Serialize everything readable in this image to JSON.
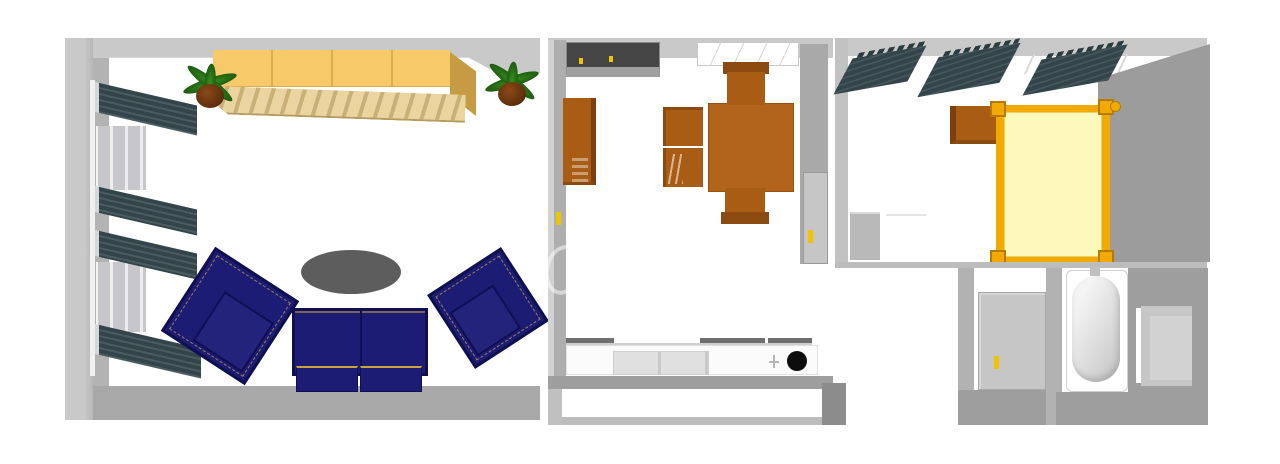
{
  "scene": {
    "kind": "3d-floor-plan-render",
    "view": "top-down bird's eye",
    "description": "Rendered floor plan of a three-section apartment: living room, kitchen-dining room, bedroom with closet and bathroom",
    "visible_text": "none"
  },
  "palette": {
    "wall-light": "#c9c9c9",
    "wall-mid": "#aeaeae",
    "wall-dark": "#9e9e9e",
    "wall-deep": "#8c8c8c",
    "slate": "#33454a",
    "slate-light": "#4a5c60",
    "wardrobe-top": "#f7c969",
    "wardrobe-side": "#c79a44",
    "slat-light": "#ead49f",
    "slat-dark": "#c8b076",
    "plant-green": "#1d5c10",
    "pot-brown": "#5a2c0c",
    "navy": "#1c1c74",
    "navy-dark": "#0f0f52",
    "navy-light": "#23237c",
    "gold-piping": "#c9a23e",
    "table-gray": "#5d5d5d",
    "wood": "#a85c14",
    "wood-dark": "#7c3f0d",
    "wood-table": "#b2641c",
    "counter-front": "#e0e0e0",
    "counter-edge": "#6e6e6e",
    "sink-black": "#0d0d0d",
    "door-gray": "#c6c6c6",
    "handle-yellow": "#f0c400",
    "bed-gold": "#f2a900",
    "bed-gold-dark": "#b37c00",
    "mattress": "#fdf8bb",
    "tub-light": "#f4f4f4",
    "tub-shade": "#c9c9c9"
  },
  "rooms": [
    {
      "id": "living-room",
      "position": "left",
      "furniture": [
        "wardrobe",
        "potted-plant-left",
        "potted-plant-right",
        "radiator-1",
        "radiator-2",
        "radiator-3",
        "radiator-4",
        "window-1",
        "window-2",
        "armchair-left",
        "armchair-right",
        "sofa-two-seat",
        "coffee-table-oval"
      ]
    },
    {
      "id": "kitchen-dining",
      "position": "center",
      "furniture": [
        "entry-door",
        "ceiling-window",
        "tall-cabinet",
        "dining-table",
        "dining-chair-top",
        "dining-chair-bottom",
        "dining-chair-left-1",
        "dining-chair-left-2",
        "kitchen-counter",
        "sink",
        "faucet",
        "side-door",
        "balcony"
      ]
    },
    {
      "id": "bedroom",
      "position": "right",
      "furniture": [
        "shelf-unit-1",
        "shelf-unit-2",
        "shelf-unit-3",
        "nightstand",
        "double-bed",
        "small-dresser"
      ]
    },
    {
      "id": "closet",
      "position": "bottom-right-left",
      "furniture": [
        "closet-door"
      ]
    },
    {
      "id": "bathroom",
      "position": "bottom-right",
      "furniture": [
        "bathtub",
        "shower"
      ]
    }
  ]
}
